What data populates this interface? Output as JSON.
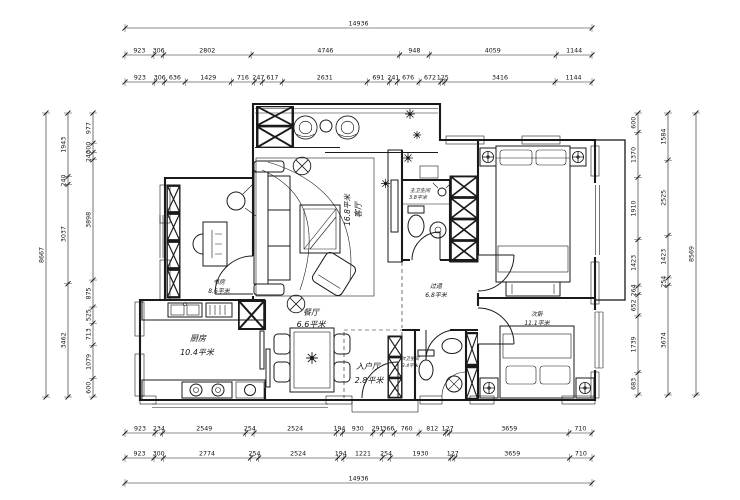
{
  "canvas": {
    "background": "#ffffff",
    "line_color": "#1a1a1a"
  },
  "dimensions": {
    "top": {
      "overall": [
        "14936"
      ],
      "row2": [
        "923",
        "306",
        "2802",
        "4746",
        "948",
        "4059",
        "1144"
      ],
      "row3": [
        "923",
        "306",
        "636",
        "1429",
        "716",
        "247",
        "617",
        "2631",
        "691",
        "241",
        "676",
        "672",
        "125",
        "3416",
        "1144"
      ]
    },
    "bottom": {
      "row1": [
        "923",
        "234",
        "2549",
        "254",
        "2524",
        "194",
        "930",
        "291",
        "366",
        "760",
        "812",
        "127",
        "3659",
        "710"
      ],
      "row2": [
        "923",
        "300",
        "2774",
        "254",
        "2524",
        "194",
        "1221",
        "254",
        "1930",
        "127",
        "3659",
        "710"
      ],
      "overall": [
        "14936"
      ]
    },
    "left": {
      "overall": [
        "8667"
      ],
      "mid": [
        "1943",
        "240",
        "3037",
        "3462"
      ],
      "inner": [
        "977",
        "300",
        "240",
        "3898",
        "875",
        "525",
        "713",
        "1079",
        "600"
      ]
    },
    "right": {
      "overall": [
        "8569"
      ],
      "mid": [
        "1584",
        "2525",
        "1423",
        "254",
        "3674"
      ],
      "inner": [
        "600",
        "1370",
        "1910",
        "1423",
        "264",
        "652",
        "1739",
        "683"
      ]
    }
  },
  "rooms": {
    "living": {
      "name": "客厅",
      "area": "16.8平米"
    },
    "dining": {
      "name": "餐厅",
      "area": "6.6平米"
    },
    "kitchen": {
      "name": "厨房",
      "area": "10.4平米"
    },
    "entry": {
      "name": "入户厅",
      "area": "2.8平米"
    },
    "study": {
      "name": "书房",
      "area": "8.6平米"
    },
    "master_bath": {
      "name": "主卫生间",
      "area": "3.8平米"
    },
    "second_bath": {
      "name": "次卫生间",
      "area": "3.4平米"
    },
    "corridor": {
      "name": "过道",
      "area": "6.8平米"
    },
    "second_bedroom": {
      "name": "次卧",
      "area": "11.1平米"
    }
  }
}
